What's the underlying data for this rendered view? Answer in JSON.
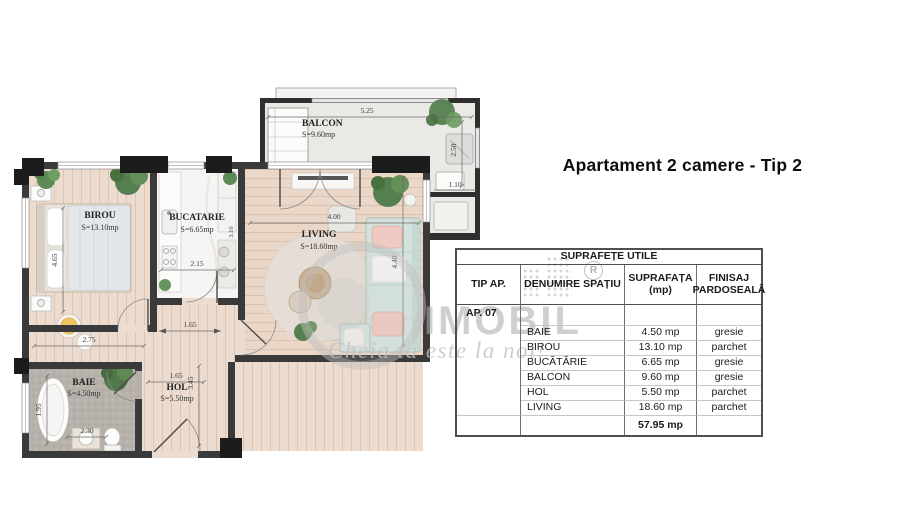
{
  "title": "Apartament 2 camere - Tip 2",
  "watermark": {
    "brand": "IMOBIL",
    "slogan": "Cheia ta este la noi!",
    "registered": "R"
  },
  "plan": {
    "rooms": {
      "balcon": {
        "name": "BALCON",
        "area": "S=9.60mp"
      },
      "birou": {
        "name": "BIROU",
        "area": "S=13.10mp"
      },
      "bucatarie": {
        "name": "BUCATARIE",
        "area": "S=6.65mp"
      },
      "living": {
        "name": "LIVING",
        "area": "S=18.60mp"
      },
      "baie": {
        "name": "BAIE",
        "area": "S=4.50mp"
      },
      "hol": {
        "name": "HOL",
        "area": "S=5.50mp"
      }
    },
    "dims": {
      "balcon_width": "5.25",
      "balcon_depth": "2.50",
      "balcon_niche": "1.10",
      "birou_depth": "4.65",
      "birou_width": "2.75",
      "bucatarie_width": "2.15",
      "bucatarie_depth": "3.10",
      "living_width": "4.00",
      "living_depth": "4.40",
      "corridor_opening": "1.65",
      "hol_width": "1.65",
      "hol_depth": "3.45",
      "baie_depth": "1.95",
      "baie_width": "2.30"
    }
  },
  "table": {
    "title": "SUPRAFEȚE UTILE",
    "headers": {
      "tip": "TIP AP.",
      "denumire": "DENUMIRE SPAȚIU",
      "suprafata_l1": "SUPRAFAȚA",
      "suprafata_l2": "(mp)",
      "finisaj_l1": "FINISAJ",
      "finisaj_l2": "PARDOSEALĂ"
    },
    "apartment": "AP. 07",
    "rows": [
      {
        "name": "BAIE",
        "area": "4.50 mp",
        "finish": "gresie"
      },
      {
        "name": "BIROU",
        "area": "13.10 mp",
        "finish": "parchet"
      },
      {
        "name": "BUCĂTĂRIE",
        "area": "6.65 mp",
        "finish": "gresie"
      },
      {
        "name": "BALCON",
        "area": "9.60 mp",
        "finish": "gresie"
      },
      {
        "name": "HOL",
        "area": "5.50 mp",
        "finish": "parchet"
      },
      {
        "name": "LIVING",
        "area": "18.60 mp",
        "finish": "parchet"
      }
    ],
    "total": "57.95 mp"
  },
  "colors": {
    "wall": "#3a3a3a",
    "wood_floor": "#ecdccf",
    "tile_floor": "#b7b1ab",
    "kitchen_floor": "#f6f5f3",
    "sofa": "#d3e2dd",
    "plant": "#567f4f",
    "watermark_gray": "#c8c8c8"
  }
}
